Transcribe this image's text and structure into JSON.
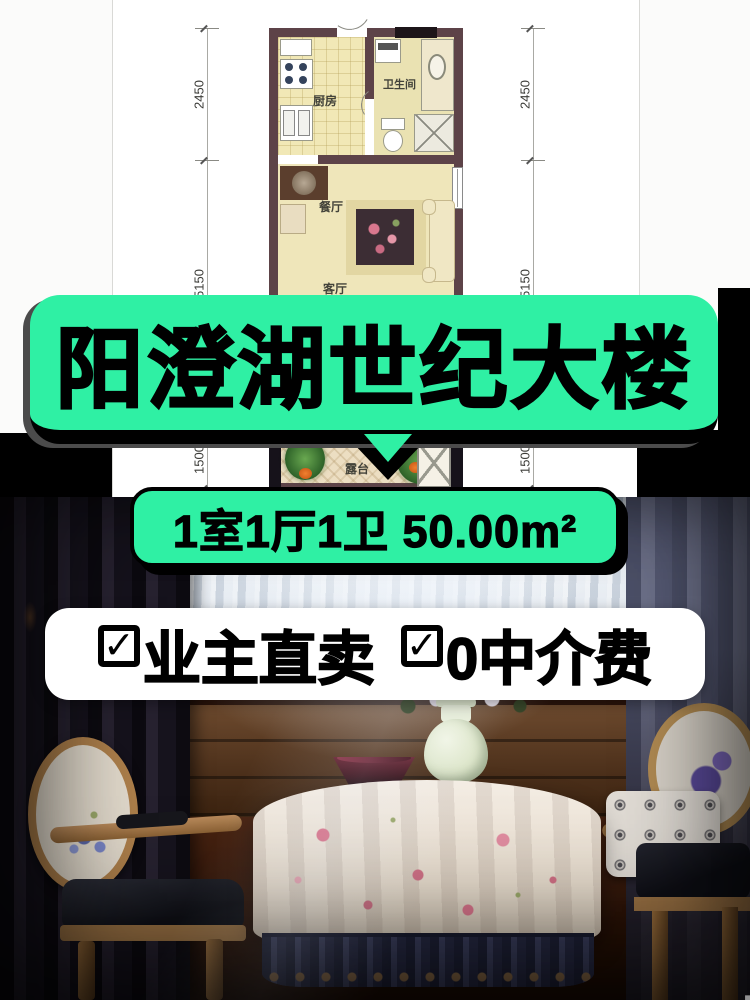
{
  "floorplan": {
    "rooms": [
      {
        "id": "kitchen",
        "label": "厨房"
      },
      {
        "id": "bathroom",
        "label": "卫生间"
      },
      {
        "id": "dining",
        "label": "餐厅"
      },
      {
        "id": "living",
        "label": "客厅"
      },
      {
        "id": "terrace",
        "label": "露台"
      }
    ],
    "dimensions": {
      "left": [
        "2450",
        "5150",
        "1500"
      ],
      "right": [
        "2450",
        "5150",
        "1500"
      ]
    }
  },
  "banners": {
    "title": "阳澄湖世纪大楼",
    "spec": "1室1厅1卫 50.00m²",
    "check_glyph": "✓",
    "features": [
      {
        "label": "业主直卖"
      },
      {
        "label": "0中介费"
      }
    ],
    "green_hex": "#2ff0a4",
    "text_hex": "#000000",
    "feature_bg_hex": "#ffffff"
  },
  "watermark": {
    "cn": "房天下",
    "en": "Fang.com"
  }
}
